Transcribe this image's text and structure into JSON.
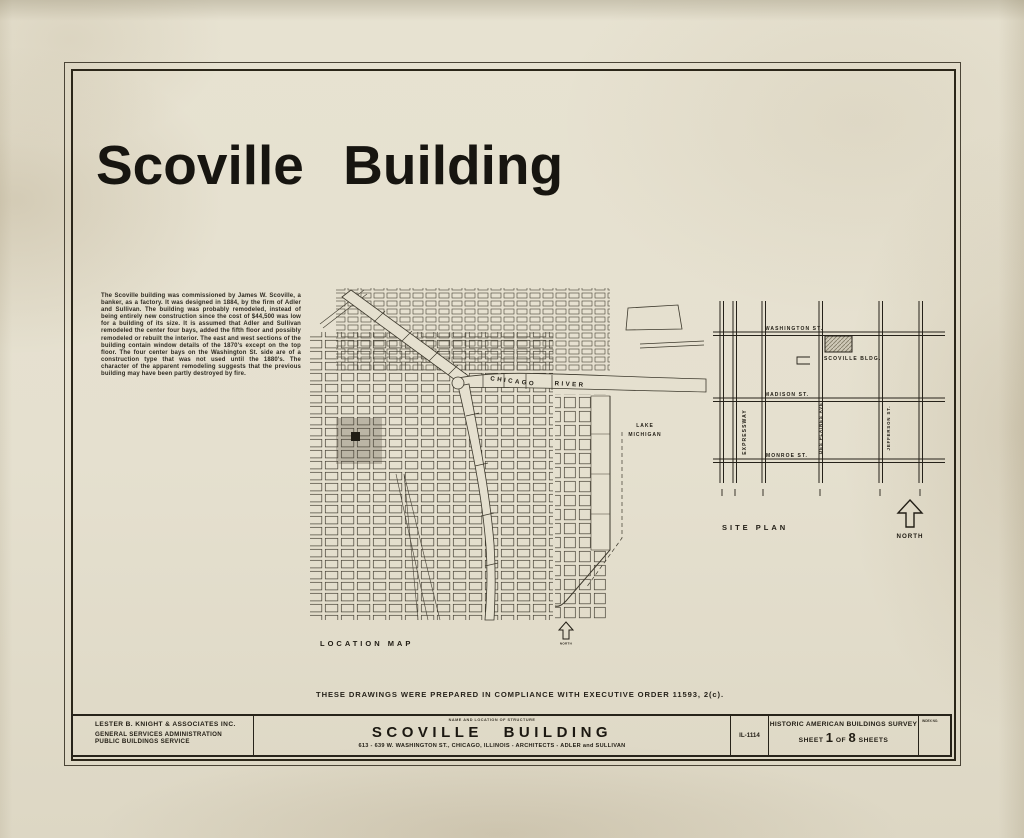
{
  "sheet": {
    "title": "Scoville Building",
    "description": "The Scoville building was commissioned by James W. Scoville, a banker, as a factory. It was designed in 1884, by the firm of Adler and Sullivan. The building was probably remodeled, instead of being entirely new construction since the cost of $44,500 was low for a building of its size. It is assumed that Adler and Sullivan remodeled the center four bays, added the fifth floor and possibly remodeled or rebuilt the interior. The east and west sections of the building contain window details of the 1870's except on the top floor. The four center bays on the Washington St. side are of a construction type that was not used until the 1880's. The character of the apparent remodeling suggests that the previous building may have been partly destroyed by fire.",
    "compliance_note": "THESE DRAWINGS WERE PREPARED IN COMPLIANCE WITH EXECUTIVE ORDER 11593, 2(c)."
  },
  "location_map": {
    "caption": "LOCATION MAP",
    "north_label": "NORTH",
    "labels": {
      "river_word1": "CHICAGO",
      "river_word2": "RIVER",
      "lake_line1": "LAKE",
      "lake_line2": "MICHIGAN"
    }
  },
  "site_plan": {
    "caption": "SITE PLAN",
    "north_label": "NORTH",
    "building_label": "SCOVILLE  BLDG.",
    "streets_horizontal": [
      "WASHINGTON ST.",
      "MADISON ST.",
      "MONROE ST."
    ],
    "streets_vertical": [
      "EXPRESSWAY",
      "DES PLAINES AVE.",
      "JEFFERSON ST."
    ]
  },
  "title_block": {
    "firm": "LESTER B. KNIGHT & ASSOCIATES INC.",
    "agency_line1": "GENERAL SERVICES ADMINISTRATION",
    "agency_line2": "PUBLIC BUILDINGS SERVICE",
    "structure_label": "NAME AND LOCATION OF STRUCTURE",
    "structure_name": "SCOVILLE BUILDING",
    "structure_address": "613 - 639 W. WASHINGTON ST., CHICAGO, ILLINOIS   -   ARCHITECTS - ADLER and SULLIVAN",
    "survey_number": "IL-1114",
    "survey_name": "HISTORIC AMERICAN BUILDINGS SURVEY",
    "sheet_word": "SHEET",
    "sheet_number": "1",
    "of_word": "OF",
    "total_sheets": "8",
    "sheets_word": "SHEETS",
    "index_label": "INDEX NO."
  },
  "colors": {
    "paper": "#e5e0cf",
    "ink": "#211d14",
    "map_line": "#464135"
  }
}
